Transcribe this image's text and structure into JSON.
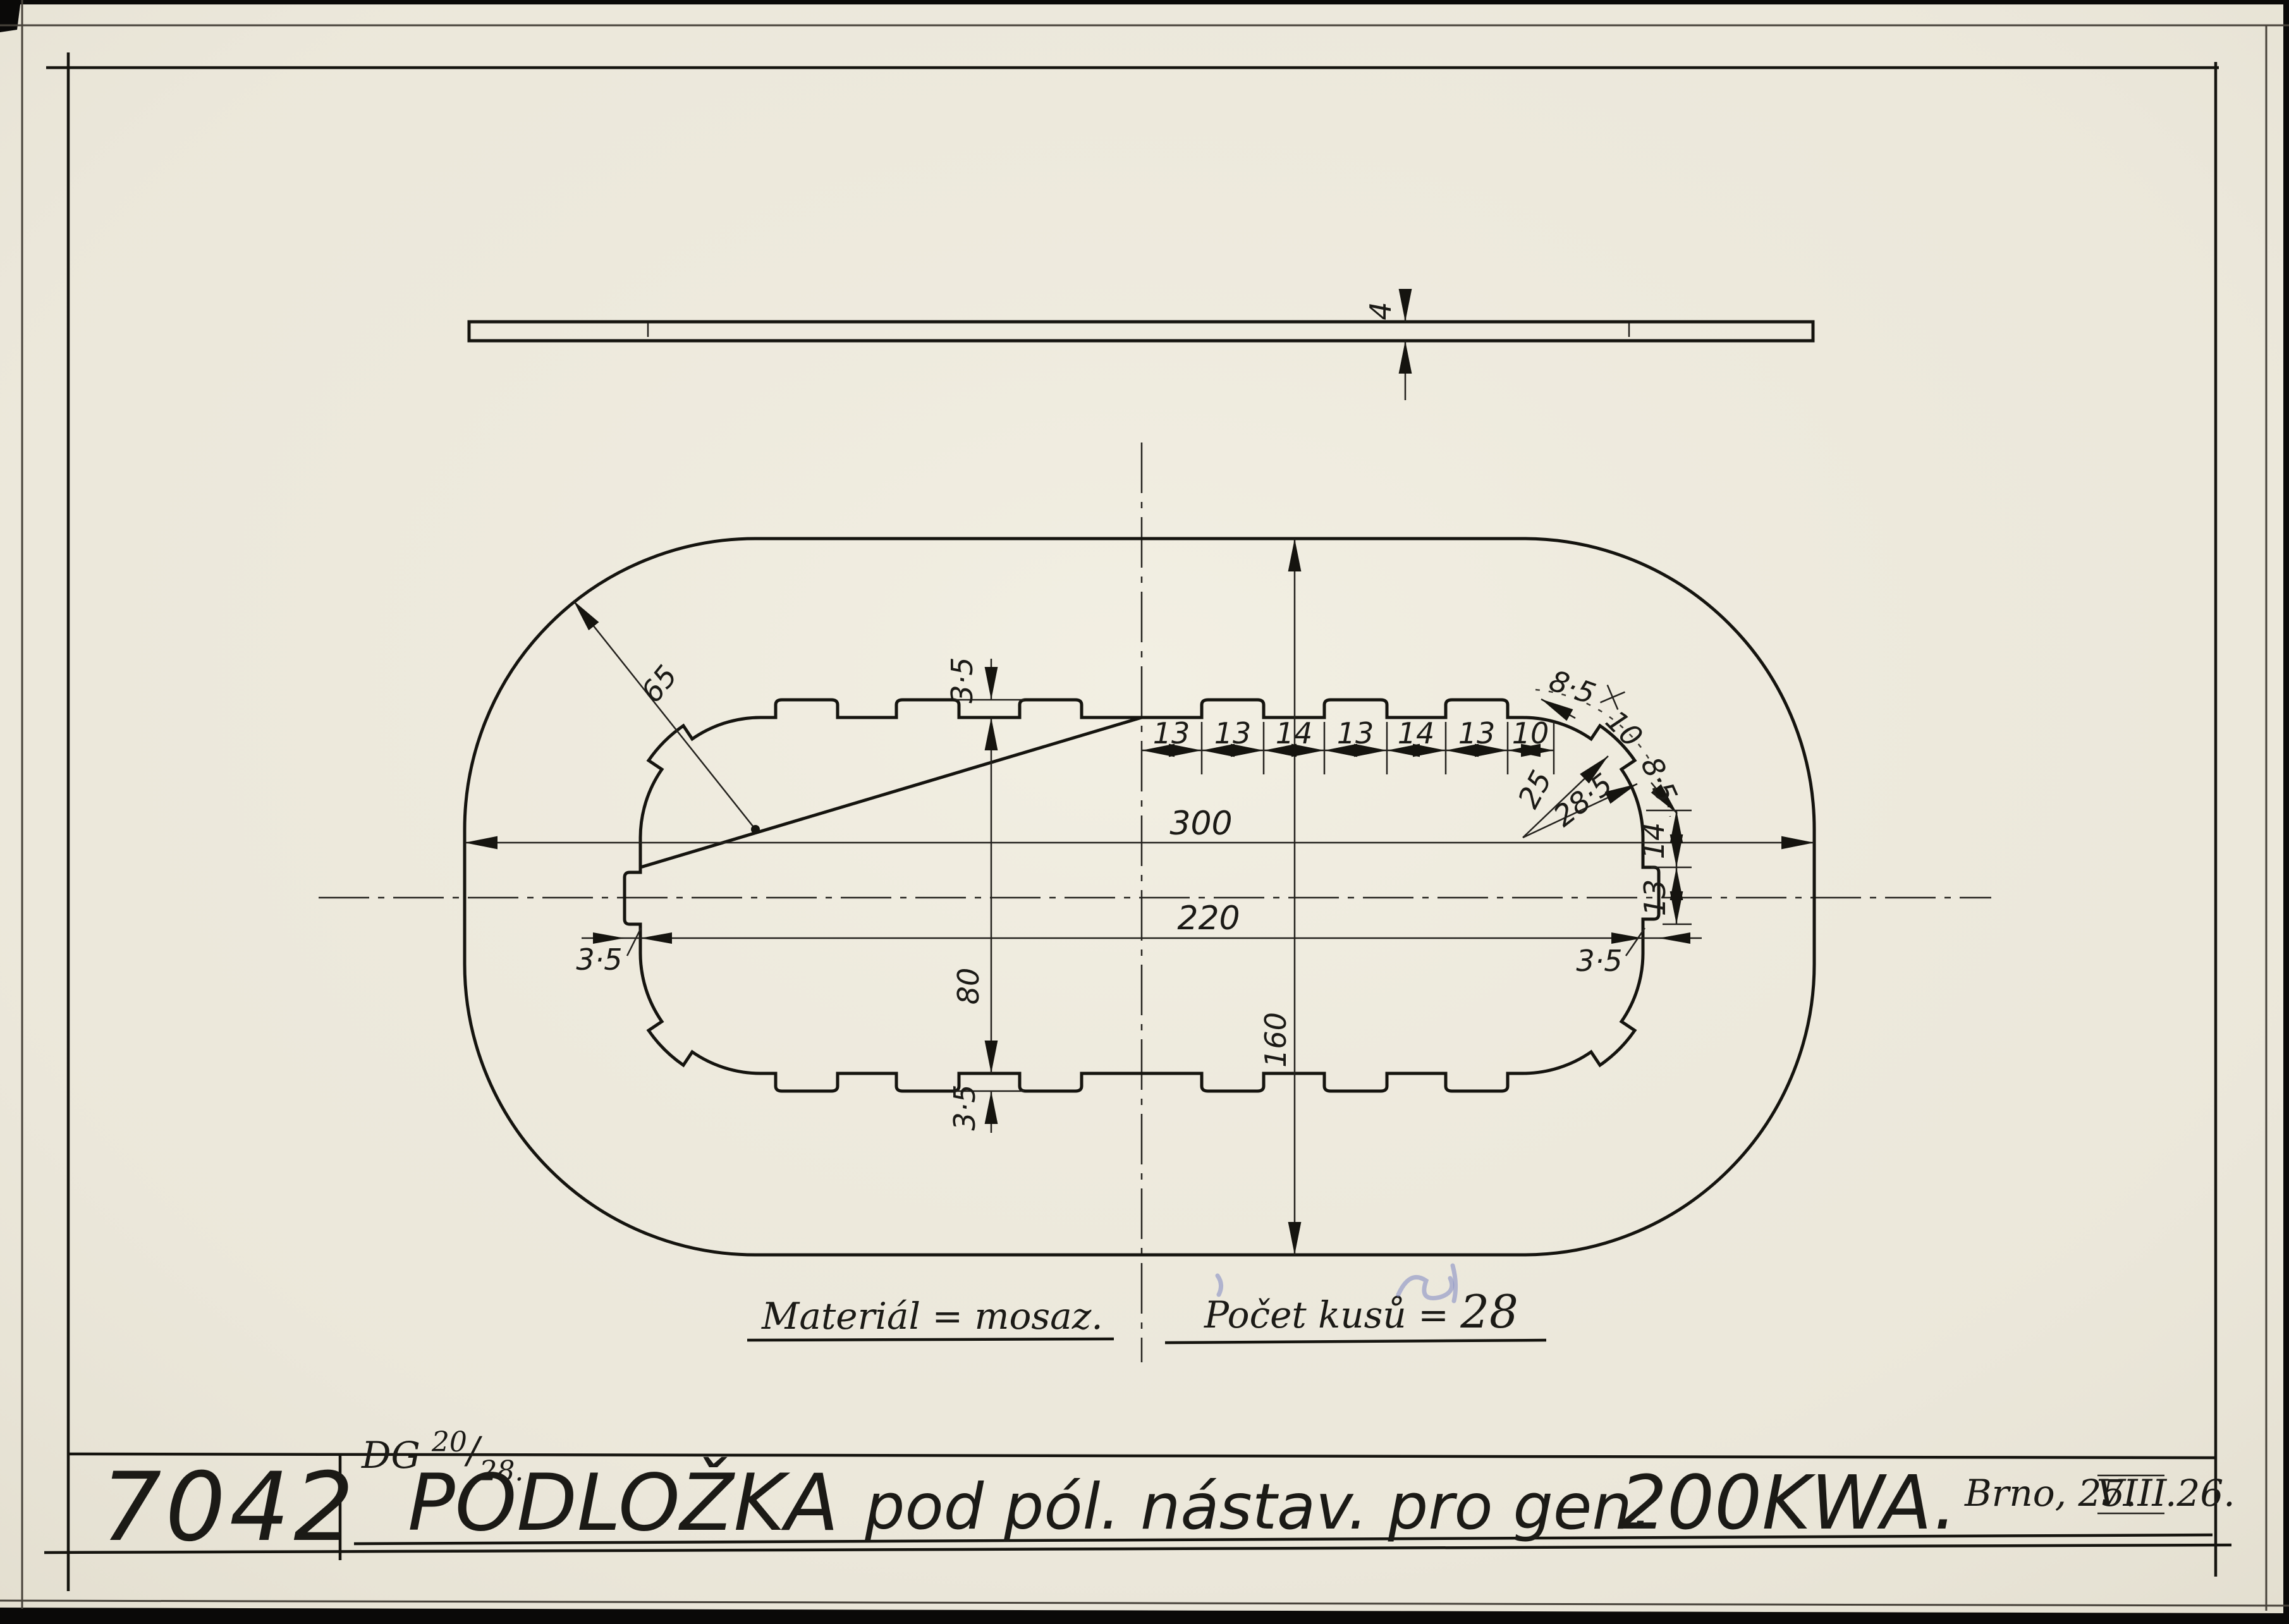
{
  "title_block": {
    "drawing_number": "7042",
    "title": "PODLOŽKA pod pól. nástav. pro gen. 200KWA.",
    "title_word": "PODLOŽKA",
    "title_middle": "pod pól. nástav. pro gen.",
    "title_model": "200KWA.",
    "date_prefix": "Brno, 25.",
    "date_month": "VIII",
    "date_suffix": ".26."
  },
  "reference": {
    "prefix": "DG",
    "numerator": "20",
    "separator": "/",
    "denominator": "28."
  },
  "notes": {
    "material": "Materiál = mosaz.",
    "quantity_label": "Počet kusů = ",
    "quantity_value": "28"
  },
  "dims": {
    "thickness": "4",
    "outer_length": "300",
    "inner_length": "220",
    "outer_height": "160",
    "inner_height": "80",
    "corner_radius": "65",
    "chain": [
      "13",
      "13",
      "14",
      "13",
      "14",
      "13",
      "10"
    ],
    "arc_gap_1": "8·5",
    "arc_tab": "10",
    "arc_gap_2": "8·5",
    "radius_tab_base": "25",
    "radius_tab_top": "28·5",
    "side_recess": "14",
    "side_tab": "13",
    "notch_depth_top": "3·5",
    "notch_depth_bottom": "3·5",
    "notch_depth_left": "3·5",
    "notch_depth_right": "3·5"
  },
  "colors": {
    "paper": "#ece8db",
    "ink": "#15140f",
    "blue_pencil": "#7d87c3"
  }
}
